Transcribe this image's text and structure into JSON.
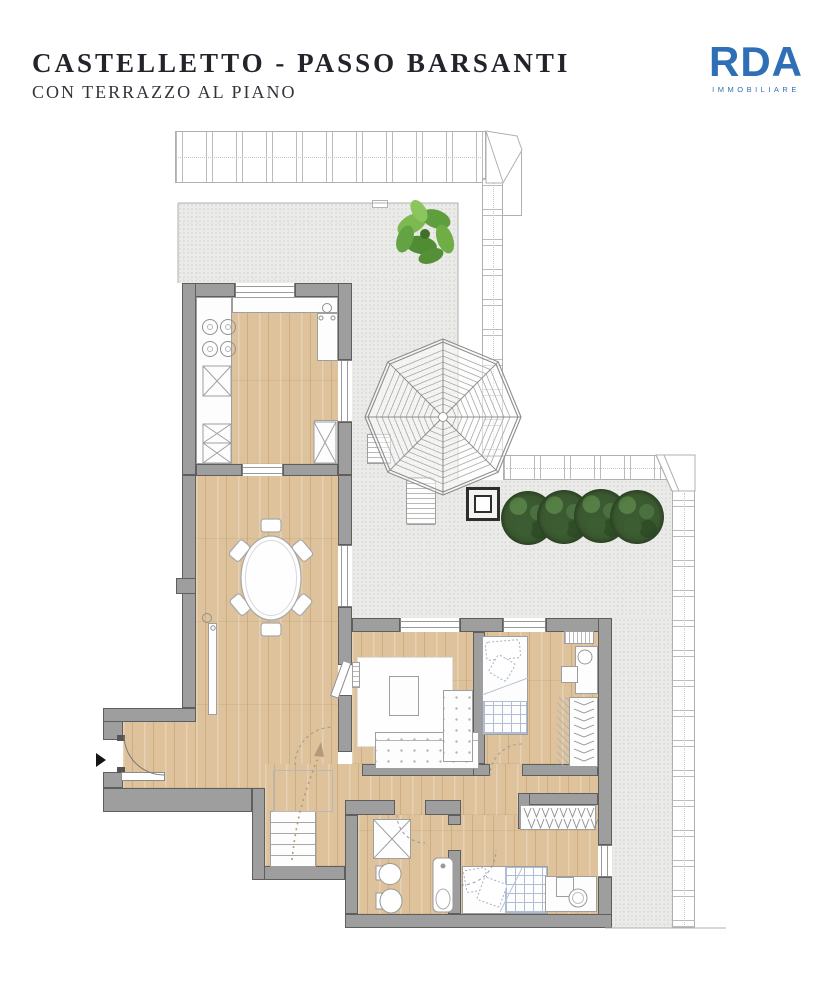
{
  "header": {
    "title": "CASTELLETTO - PASSO BARSANTI",
    "subtitle": "CON TERRAZZO AL PIANO",
    "text_color": "#23232b"
  },
  "logo": {
    "name": "RDA",
    "tagline": "IMMOBILIARE",
    "brand_color": "#2e6fb5"
  },
  "floorplan": {
    "type": "apartment-floor-plan-with-terrace",
    "colors": {
      "wall": "#9e9e9e",
      "wood_floor": "#dec29b",
      "terrace_paving": "#ebebe9",
      "hedge_green": "#3c5a31",
      "plant_green": "#6fae4a",
      "roof_edge": "#ffffff"
    },
    "elements": [
      "roof-edge-band",
      "terrace",
      "pergola",
      "hedge-row",
      "planter",
      "potted-plant",
      "sun-lounger",
      "kitchen",
      "dining-area",
      "living-area",
      "bedroom-1",
      "bedroom-2",
      "bathroom",
      "wardrobe",
      "walk-in-closet",
      "entrance-door",
      "staircase"
    ]
  }
}
